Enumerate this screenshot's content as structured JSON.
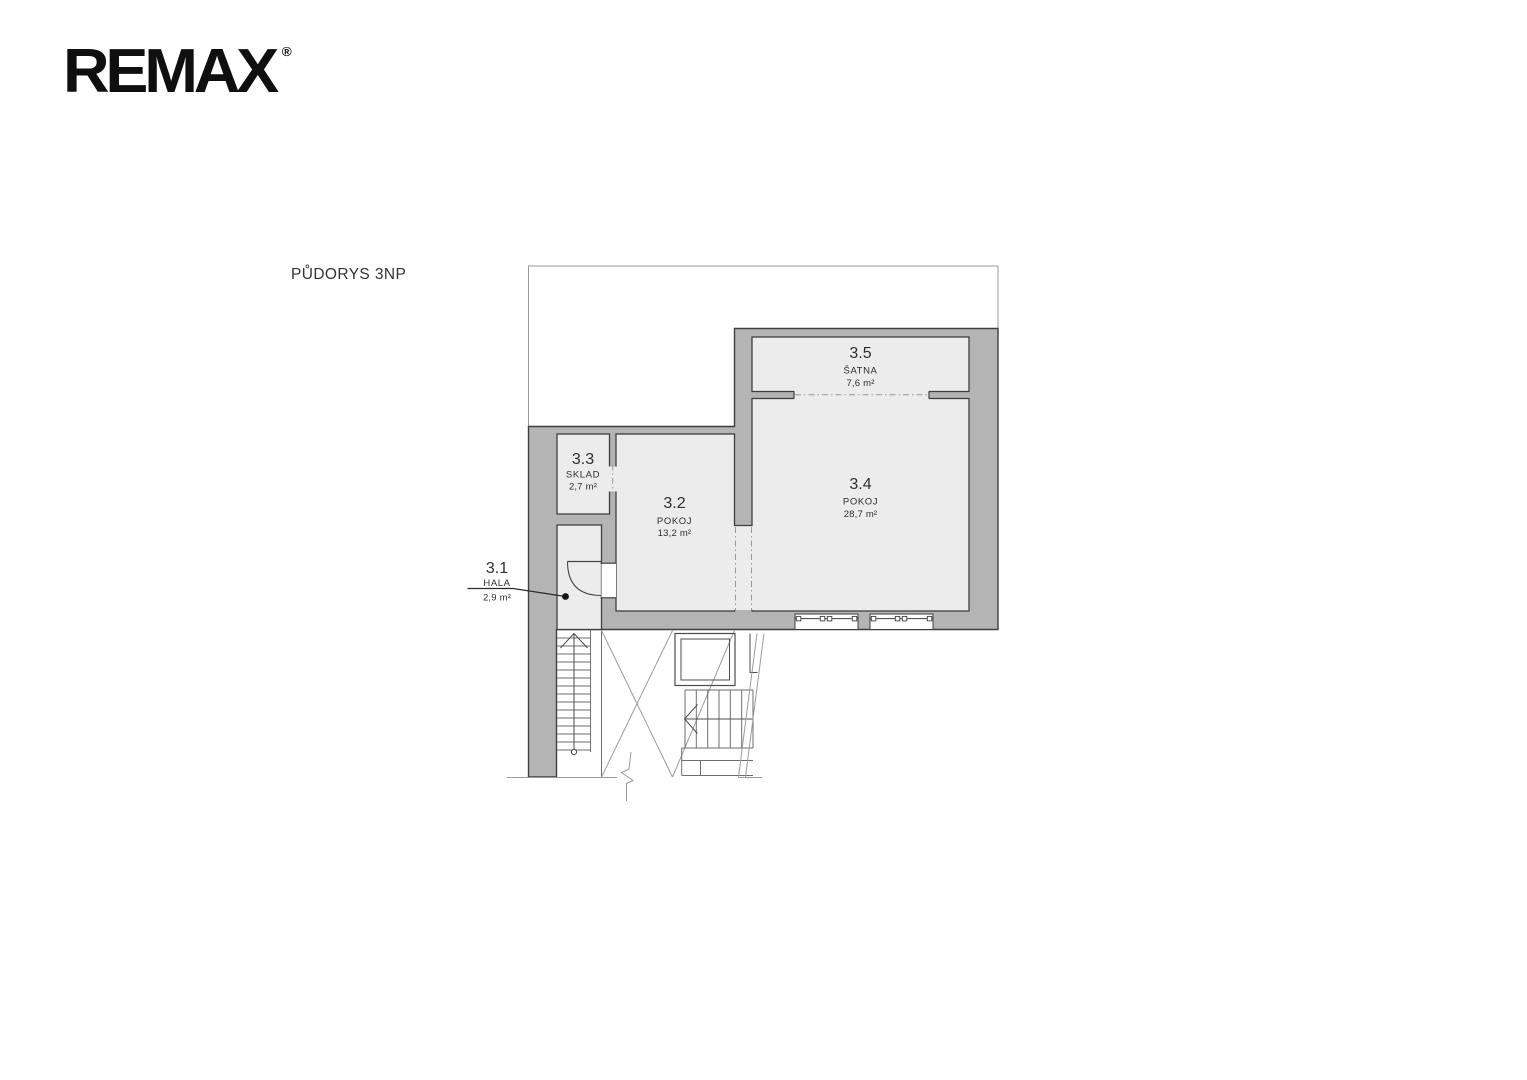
{
  "logo": {
    "text": "REMAX",
    "registered": "®"
  },
  "plan": {
    "title": "PŮDORYS 3NP",
    "rooms": [
      {
        "number": "3.1",
        "name": "HALA",
        "area": "2,9 m²"
      },
      {
        "number": "3.2",
        "name": "POKOJ",
        "area": "13,2 m²"
      },
      {
        "number": "3.3",
        "name": "SKLAD",
        "area": "2,7 m²"
      },
      {
        "number": "3.4",
        "name": "POKOJ",
        "area": "28,7 m²"
      },
      {
        "number": "3.5",
        "name": "ŠATNA",
        "area": "7,6 m²"
      }
    ],
    "colors": {
      "wall": "#b4b4b4",
      "room": "#ececec",
      "outline": "#3f3f3f",
      "thin_line": "#9a9a9a"
    }
  }
}
